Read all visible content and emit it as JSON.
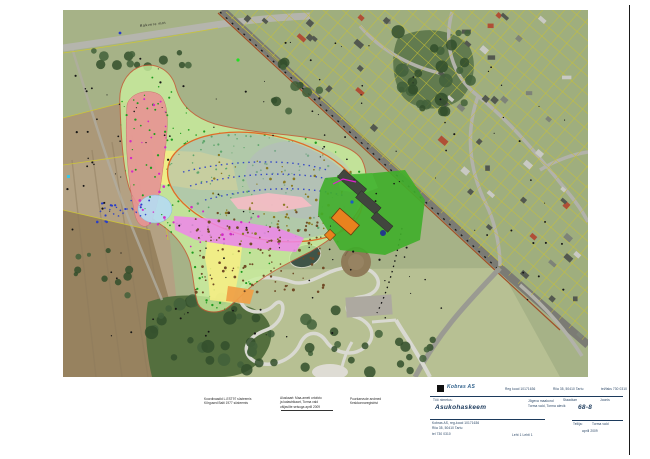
{
  "map": {
    "road_label": "Rakvere mnt",
    "palette": {
      "zone_pale_green": "#c9ef9e",
      "zone_red": "#e89494",
      "zone_yellow": "#f6ee84",
      "zone_orange": "#f0a045",
      "zone_light_blue": "#b6dcf2",
      "mound_gray": "#9fb0ba",
      "mound_outline": "#e06b28",
      "zone_magenta": "#ee86ea",
      "zone_pink": "#f6bcc4",
      "facility_green": "#3fae2a",
      "building_orange": "#e8821e",
      "cadastral_yellow": "#c9c236",
      "boundary_red": "#c85a35"
    }
  },
  "notes": {
    "n1": [
      "Koordinaadid L-EST97 süsteemis",
      "Kõrgused Balti 1977 süsteemis"
    ],
    "n2": [
      "Aluskaart: Maa-ameti ortofoto",
      "ja katastrikaart, Torma vald",
      "väljavõte seisuga aprill 2009"
    ],
    "n3": [
      "Puurkaevude andmed",
      "Keskkonnaregistrist"
    ]
  },
  "titleblock": {
    "company": "Kobras AS",
    "info": [
      "Reg kood 10171636",
      "Riia 35, 50410 Tartu",
      "tel/faks 730 0310"
    ],
    "work_label": "Töö nimetus:",
    "title": "Asukohaskeem",
    "project": [
      "Jõgeva maakond",
      "Torma vald, Torma alevik"
    ],
    "stage_label": "Staadium",
    "drawing_label": "Joonis",
    "drawing_no": "68-8",
    "client_label": "Tellija:",
    "client": "Torma vald",
    "date": "aprill 2009",
    "address": [
      "Kobras AS, reg-kood 10171636",
      "Riia 35, 50410 Tartu",
      "tel 730 0310"
    ],
    "sheet_info": "Leht 1  Lehti 1"
  },
  "gen": {
    "seed": 12345,
    "scatter": [
      {
        "g": "g-green-dots",
        "r": [
          118,
          62,
          250,
          250
        ],
        "n": 380,
        "s": 0.9,
        "c": "#1f9c1f"
      },
      {
        "g": "g-olive-dots",
        "r": [
          205,
          150,
          150,
          95
        ],
        "n": 70,
        "s": 1.0,
        "c": "#8a7a22"
      },
      {
        "g": "g-brown-dots",
        "r": [
          195,
          212,
          130,
          82
        ],
        "n": 110,
        "s": 1.1,
        "c": "#6f4a26"
      },
      {
        "g": "g-black-dots",
        "r": [
          88,
          40,
          330,
          300
        ],
        "n": 90,
        "s": 0.8,
        "c": "#161616"
      },
      {
        "g": "g-black-dots",
        "r": [
          420,
          60,
          160,
          250
        ],
        "n": 28,
        "s": 0.8,
        "c": "#161616"
      },
      {
        "g": "g-black-dots",
        "r": [
          66,
          60,
          70,
          220
        ],
        "n": 22,
        "s": 0.8,
        "c": "#161616"
      },
      {
        "g": "g-magenta-dots",
        "r": [
          128,
          95,
          45,
          130
        ],
        "n": 22,
        "s": 1.0,
        "c": "#d22cc6"
      },
      {
        "g": "g-magenta-dots",
        "r": [
          155,
          205,
          140,
          42
        ],
        "n": 18,
        "s": 1.0,
        "c": "#d22cc6"
      },
      {
        "g": "g-blue-dots",
        "r": [
          96,
          200,
          55,
          22
        ],
        "n": 18,
        "s": 1.0,
        "c": "#2a3ec8"
      }
    ],
    "houses": {
      "n": 62
    },
    "trees": [
      {
        "r": [
          70,
          50,
          125,
          20
        ],
        "n": 13,
        "r0": 2.5,
        "r1": 5
      },
      {
        "r": [
          396,
          30,
          78,
          82
        ],
        "n": 26,
        "r0": 3,
        "r1": 7
      },
      {
        "r": [
          150,
          298,
          112,
          72
        ],
        "n": 26,
        "r0": 3,
        "r1": 7
      },
      {
        "r": [
          248,
          300,
          120,
          68
        ],
        "n": 13,
        "r0": 2.5,
        "r1": 6
      },
      {
        "r": [
          330,
          330,
          105,
          42
        ],
        "n": 12,
        "r0": 2.5,
        "r1": 6
      },
      {
        "r": [
          68,
          235,
          85,
          62
        ],
        "n": 10,
        "r0": 2,
        "r1": 4.5
      },
      {
        "r": [
          268,
          58,
          66,
          55
        ],
        "n": 10,
        "r0": 2.5,
        "r1": 5
      }
    ],
    "parcels": {
      "spacing": 13.5,
      "color": "#c9c236"
    }
  }
}
